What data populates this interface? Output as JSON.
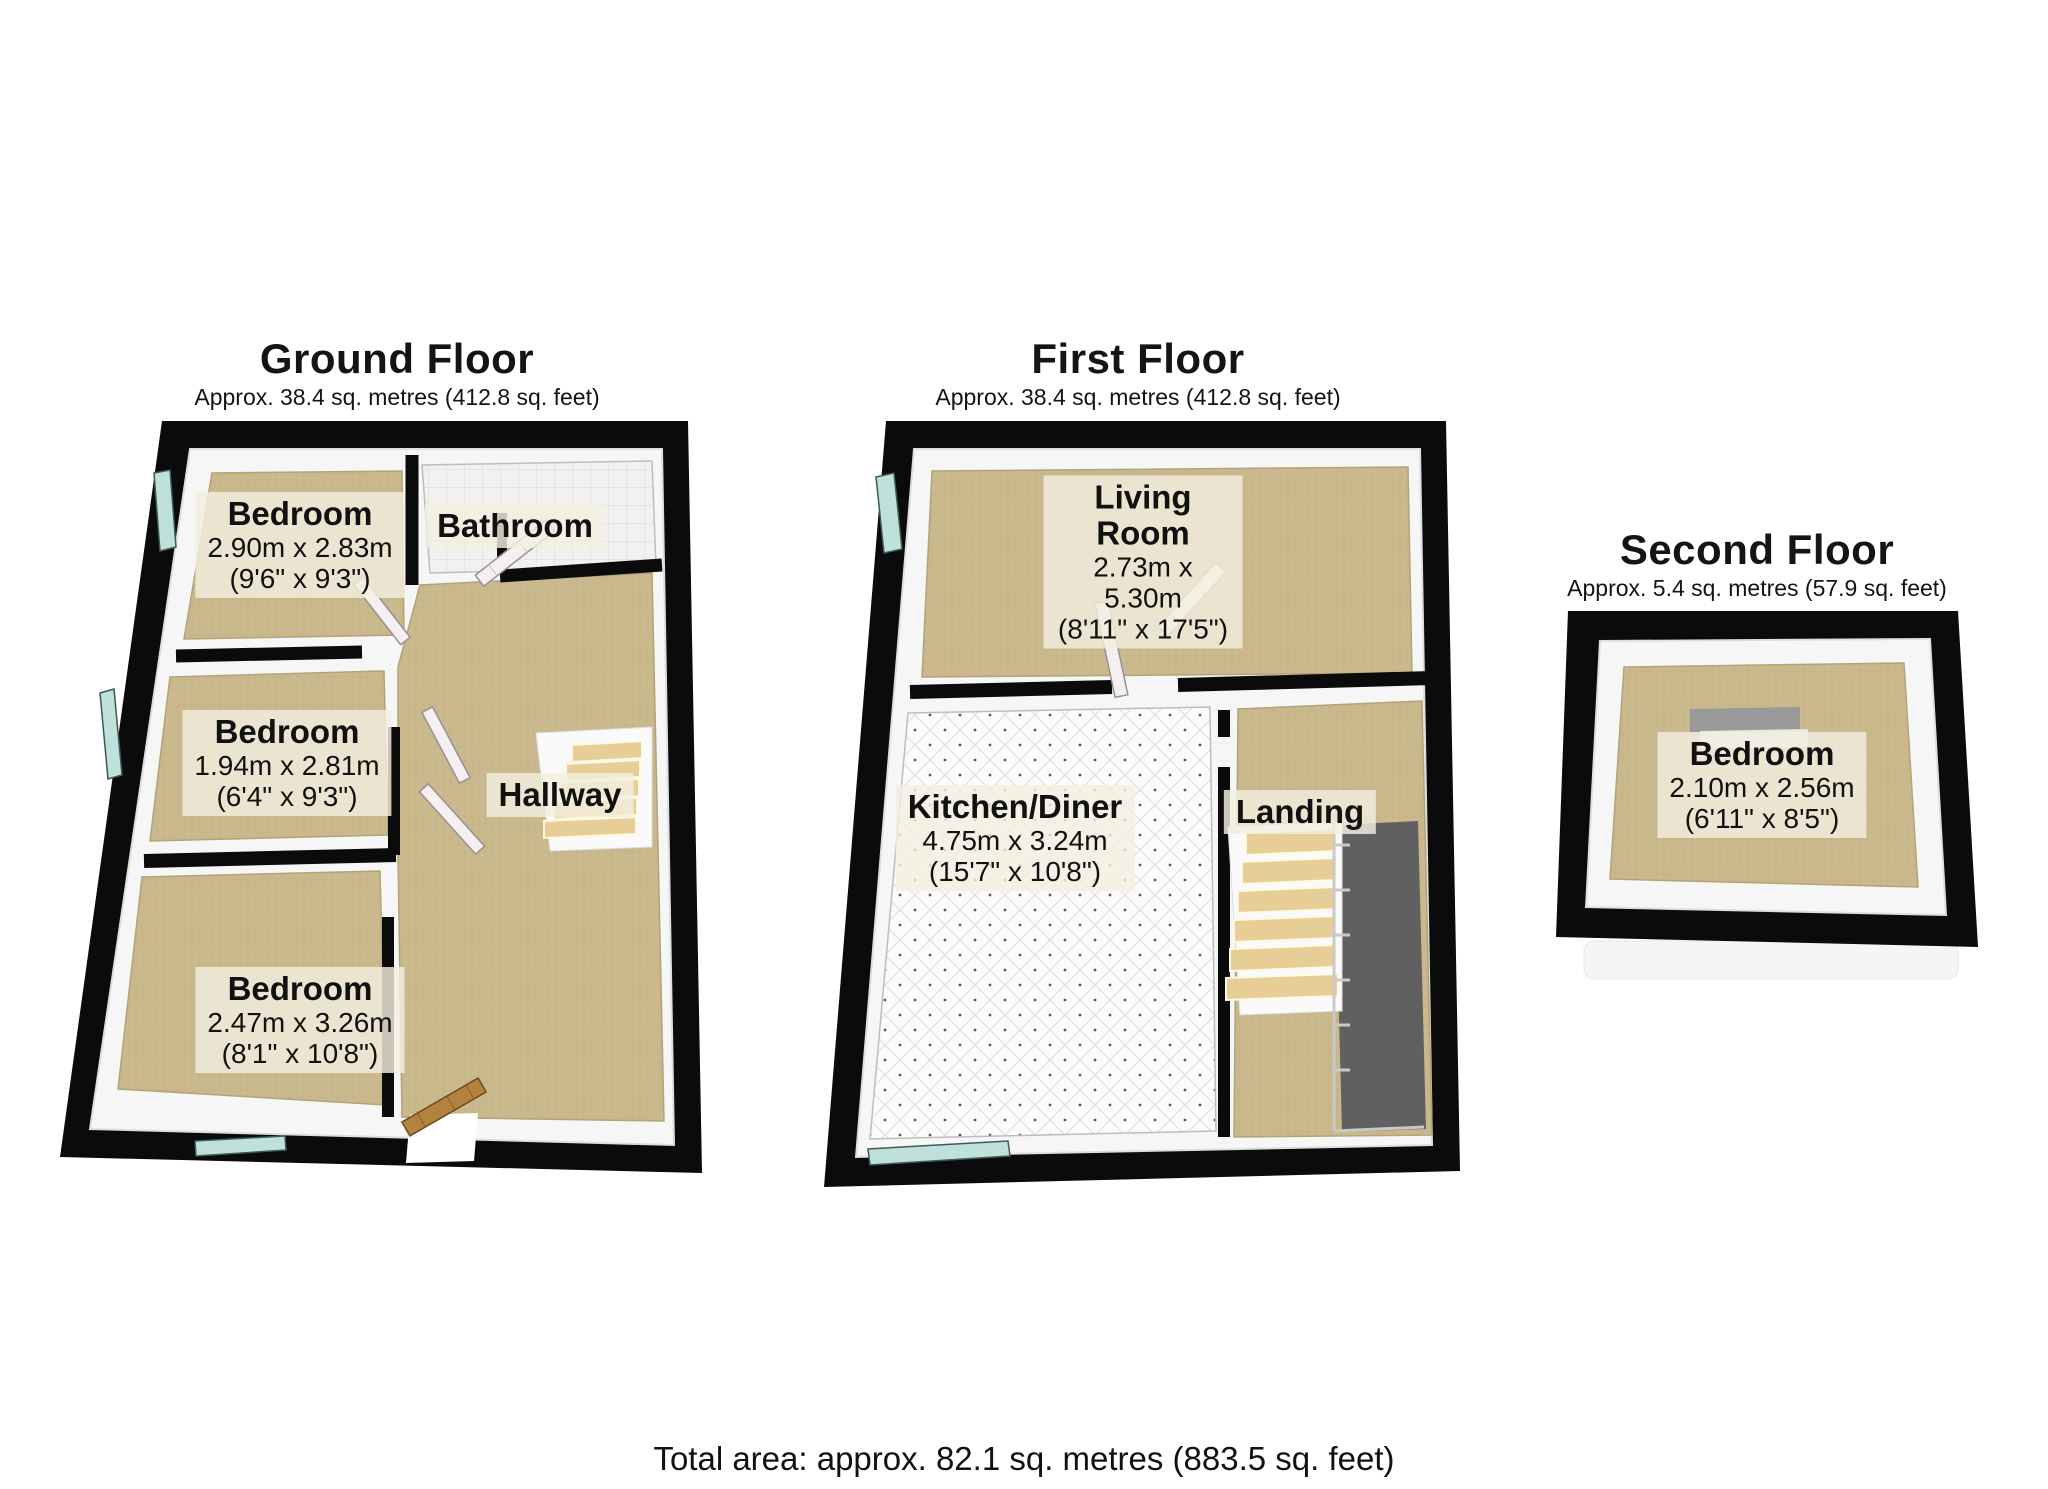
{
  "total_area": "Total area: approx. 82.1 sq. metres (883.5 sq. feet)",
  "floors": [
    {
      "title": "Ground Floor",
      "area": "Approx. 38.4 sq. metres (412.8 sq. feet)",
      "rooms": [
        {
          "name": "Bedroom",
          "dims_m": "2.90m x 2.83m",
          "dims_ft": "(9'6\" x 9'3\")"
        },
        {
          "name": "Bathroom"
        },
        {
          "name": "Bedroom",
          "dims_m": "1.94m x 2.81m",
          "dims_ft": "(6'4\" x 9'3\")"
        },
        {
          "name": "Hallway"
        },
        {
          "name": "Bedroom",
          "dims_m": "2.47m x 3.26m",
          "dims_ft": "(8'1\" x 10'8\")"
        }
      ]
    },
    {
      "title": "First Floor",
      "area": "Approx. 38.4 sq. metres (412.8 sq. feet)",
      "rooms": [
        {
          "name": "Living Room",
          "dims_m": "2.73m x 5.30m",
          "dims_ft": "(8'11\" x 17'5\")"
        },
        {
          "name": "Kitchen/Diner",
          "dims_m": "4.75m x 3.24m",
          "dims_ft": "(15'7\" x 10'8\")"
        },
        {
          "name": "Landing"
        }
      ]
    },
    {
      "title": "Second Floor",
      "area": "Approx. 5.4 sq. metres (57.9 sq. feet)",
      "rooms": [
        {
          "name": "Bedroom",
          "dims_m": "2.10m x 2.56m",
          "dims_ft": "(6'11\" x 8'5\")"
        }
      ]
    }
  ],
  "colors": {
    "wall": "#0b0b0b",
    "wall_face": "#f6f6f6",
    "carpet": "#c9b88c",
    "tile": "#f1f1ef",
    "window_glass": "#bfe0db",
    "stairs": "#e6ce96",
    "wood_door": "#b5813f",
    "stairwell_void": "#606060",
    "label_background": "#f3eedf"
  }
}
